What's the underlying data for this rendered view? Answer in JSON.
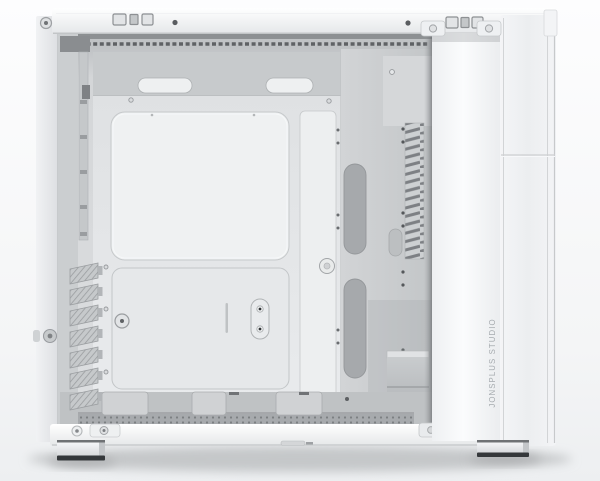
{
  "scene": {
    "description": "Studio product photo of a white desktop PC case, side view with side panel removed showing empty white interior",
    "background_top": "#fdfdfe",
    "background_bottom": "#edeff1"
  },
  "brand": {
    "vertical_label": "JONSPLUS STUDIO",
    "color": "#a6abaf"
  },
  "case": {
    "shell_color": "#f6f7f8",
    "interior_color": "#d7d9db",
    "tray_color": "#e6e8ea",
    "louver_color": "#7d8084",
    "rubber_foot_color": "#35383b",
    "expansion_slot_count": 7,
    "feet_count": 2,
    "top_port_cutouts_left": 3,
    "top_port_cutouts_right": 3,
    "cable_cutouts_top": 2,
    "front_cable_cutouts": 2
  }
}
